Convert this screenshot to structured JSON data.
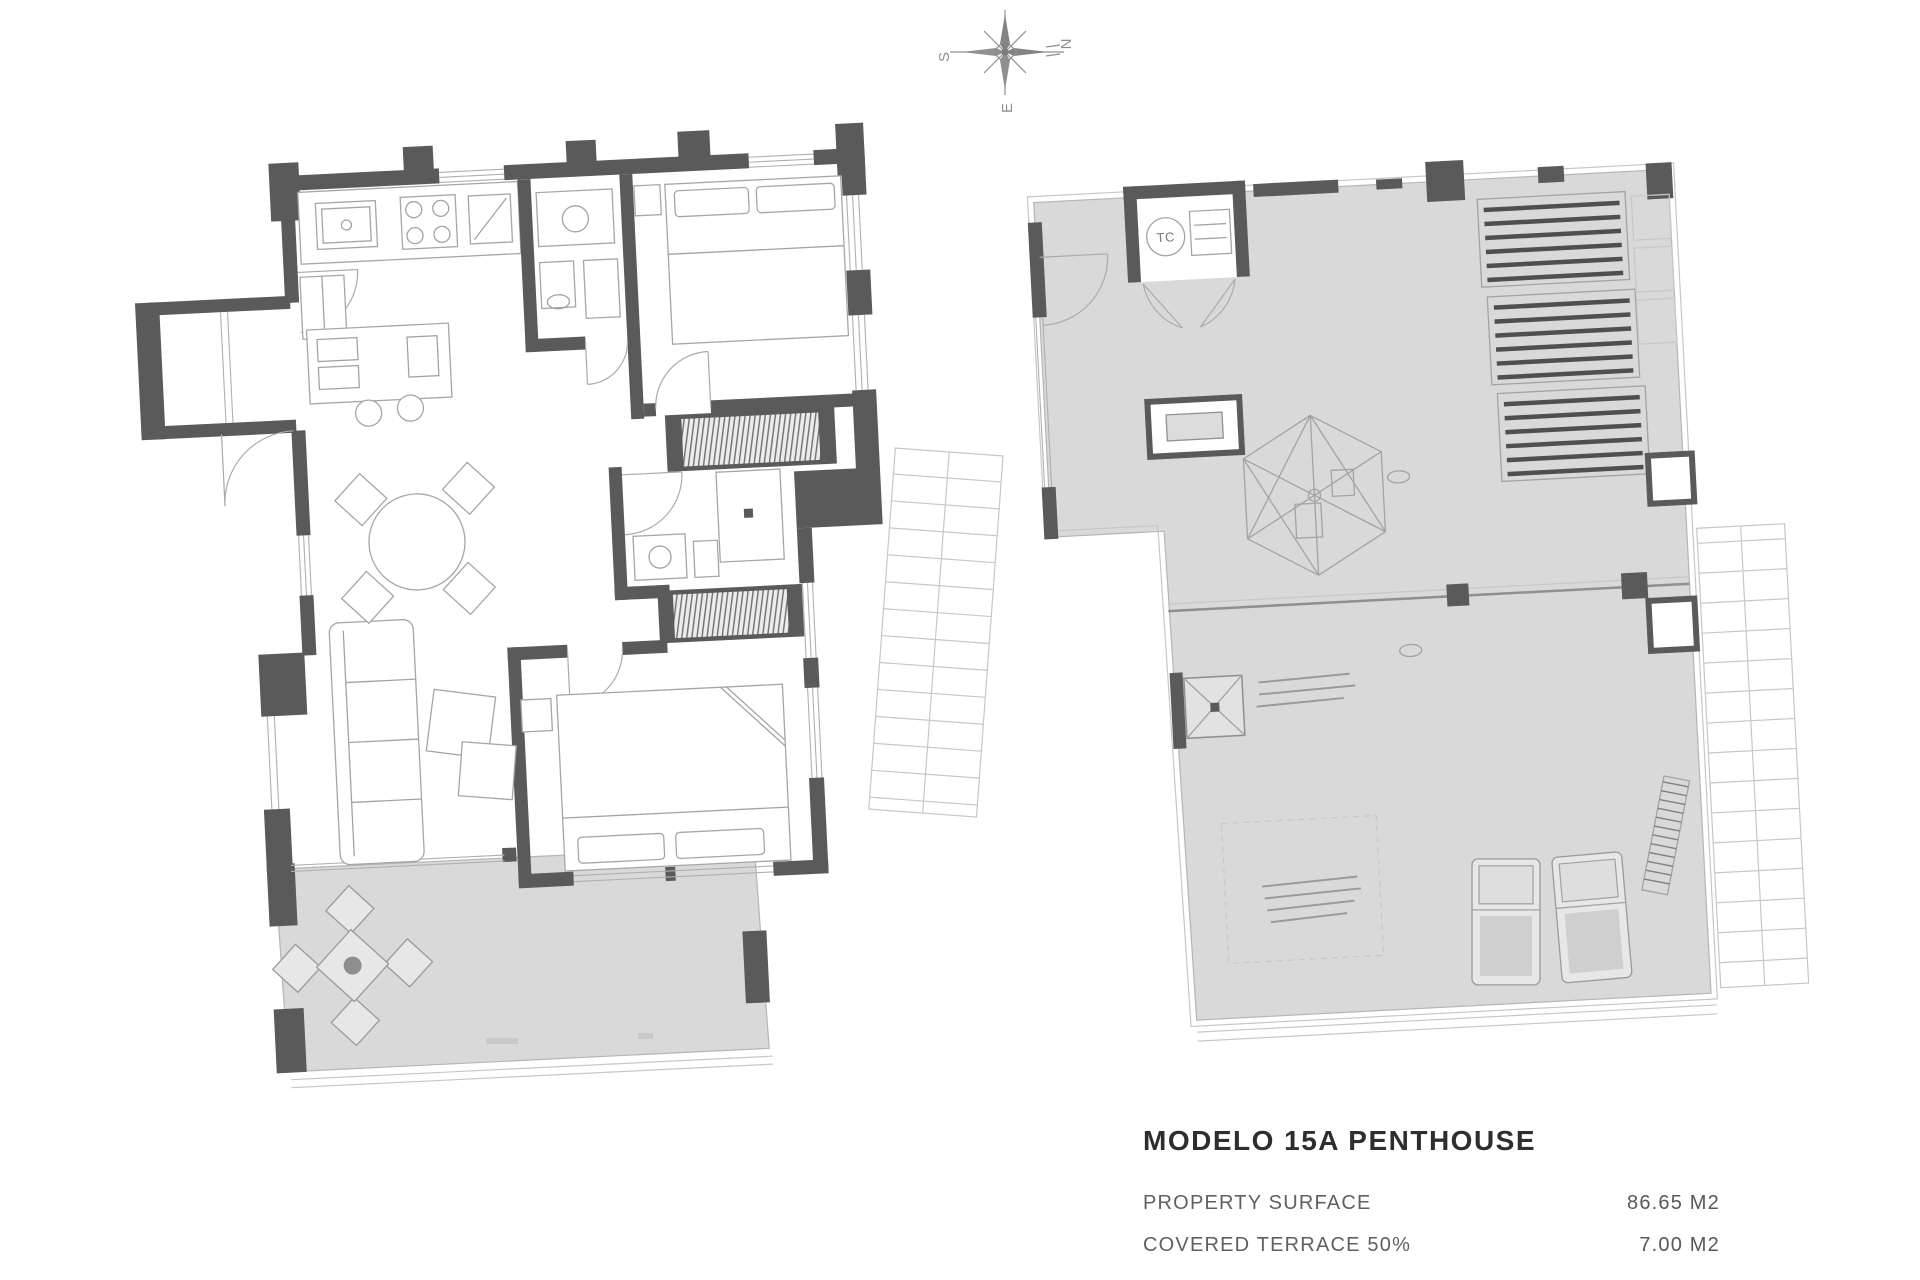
{
  "page": {
    "background": "#ffffff",
    "document_type": "architectural floor plan sheet"
  },
  "compass": {
    "letter_north": "N",
    "letter_south": "S",
    "letter_east": "E",
    "rotation_deg": -90
  },
  "left_plan": {
    "description": "apartment interior floor plan with kitchen, living-dining room, two bedrooms, two bathrooms and covered terrace"
  },
  "right_plan": {
    "utility_room_label": "TC",
    "description": "roof terrace plan with pergolas, dome skylight and sun loungers"
  },
  "title_block": {
    "title": "MODELO 15A PENTHOUSE",
    "specs": [
      {
        "label": "PROPERTY SURFACE",
        "value": "86.65 M2"
      },
      {
        "label": "COVERED TERRACE 50%",
        "value": "7.00 M2"
      }
    ]
  },
  "colors": {
    "wall": "#5a5a5a",
    "terrace_fill": "#d9d9d9",
    "thin_line": "#a3a3a3",
    "title_text": "#2e2e2e",
    "spec_text": "#606060"
  }
}
